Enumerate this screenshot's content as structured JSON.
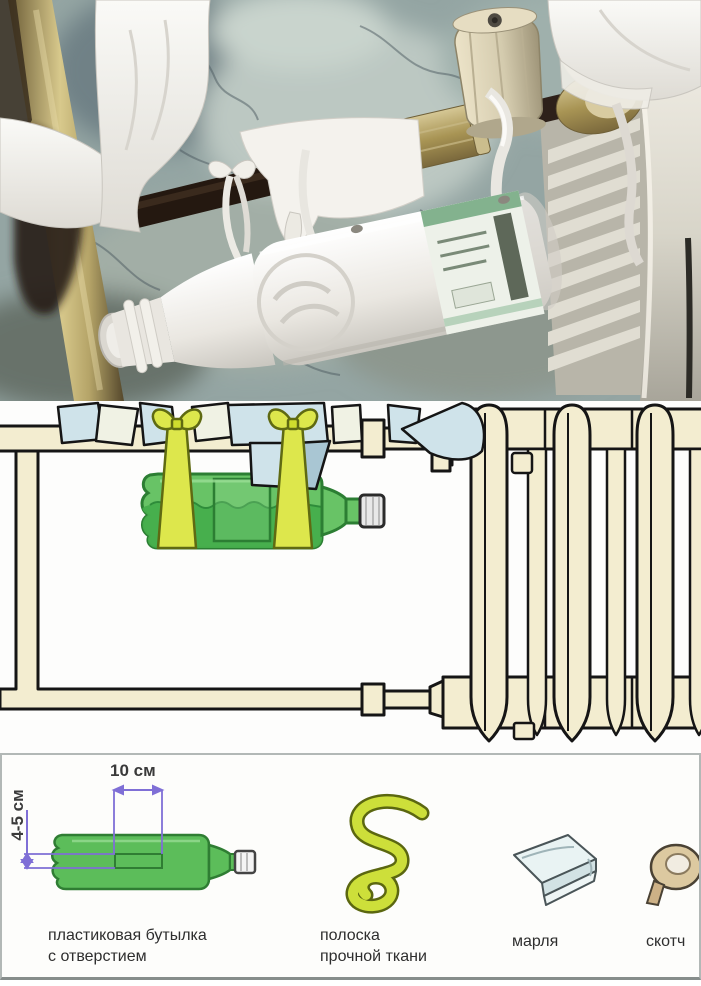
{
  "measurements": {
    "hole_width": "10 см",
    "hole_height": "4-5 см"
  },
  "materials": {
    "items": [
      {
        "icon": "bottle-with-hole-icon",
        "line1": "пластиковая бутылка",
        "line2": "с отверстием"
      },
      {
        "icon": "fabric-strip-icon",
        "line1": "полоска",
        "line2": "прочной ткани"
      },
      {
        "icon": "gauze-icon",
        "line1": "марля",
        "line2": ""
      },
      {
        "icon": "tape-icon",
        "line1": "скотч",
        "line2": ""
      }
    ]
  },
  "colors": {
    "bottle_green": "#68c366",
    "water_green": "#46ae4c",
    "ribbon_yellow": "#dde74c",
    "fabric_blue": "#cfe3ea",
    "pipe_cream": "#f3edd0",
    "measure_purple": "#7f6fd6",
    "outline_black": "#151515",
    "panel_border": "#b2b8b6"
  }
}
